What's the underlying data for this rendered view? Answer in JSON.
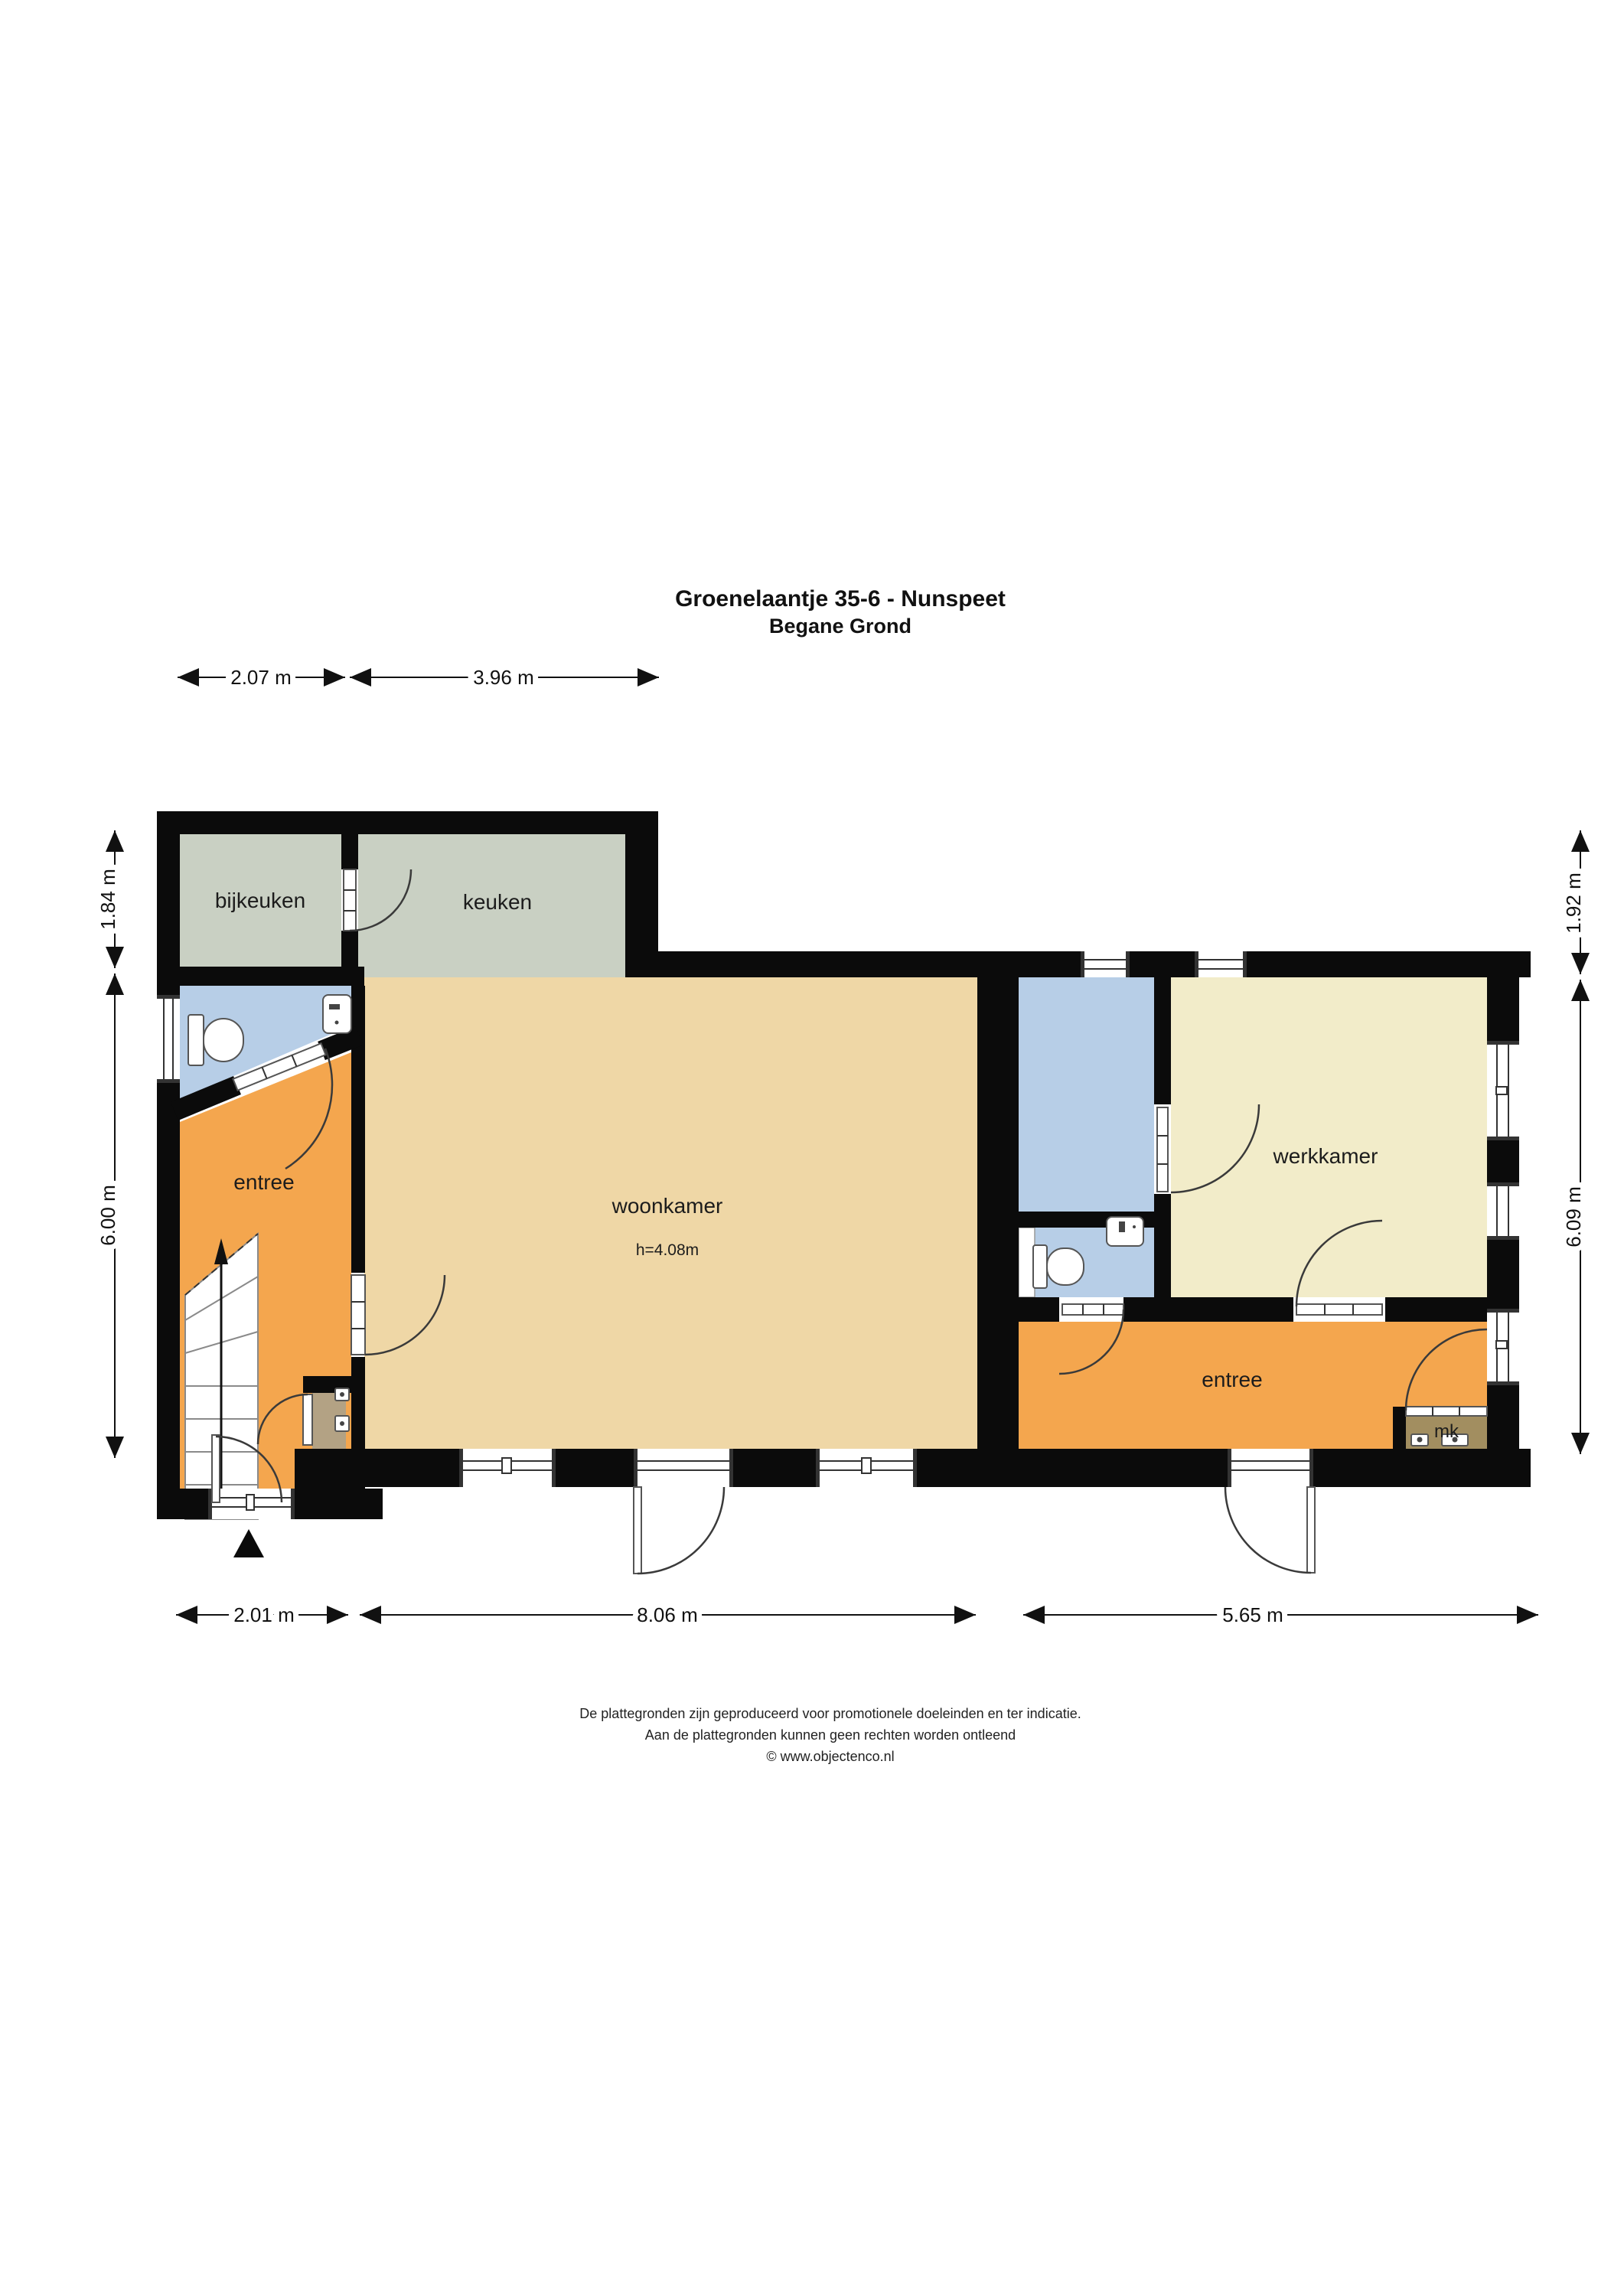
{
  "title": {
    "line1": "Groenelaantje 35-6 - Nunspeet",
    "line2": "Begane Grond"
  },
  "rooms": {
    "bijkeuken": {
      "label": "bijkeuken"
    },
    "keuken": {
      "label": "keuken"
    },
    "entree_left": {
      "label": "entree"
    },
    "woonkamer": {
      "label": "woonkamer",
      "height_note": "h=4.08m"
    },
    "werkkamer": {
      "label": "werkkamer"
    },
    "entree_right": {
      "label": "entree"
    },
    "meterkast": {
      "label": "mk"
    }
  },
  "dimensions": {
    "top": [
      {
        "label": "2.07 m"
      },
      {
        "label": "3.96 m"
      }
    ],
    "bottom": [
      {
        "label": "2.01 m"
      },
      {
        "label": "8.06 m"
      },
      {
        "label": "5.65 m"
      }
    ],
    "left": [
      {
        "label": "1.84 m"
      },
      {
        "label": "6.00 m"
      }
    ],
    "right": [
      {
        "label": "1.92 m"
      },
      {
        "label": "6.09 m"
      }
    ]
  },
  "footer": {
    "line1": "De plattegronden zijn geproduceerd voor promotionele doeleinden en ter indicatie.",
    "line2": "Aan de plattegronden kunnen geen rechten worden ontleend",
    "line3": "© www.objectenco.nl"
  },
  "colors": {
    "wall": "#0b0b0b",
    "kitchen": "#c9d0c3",
    "living": "#efd7a6",
    "hall": "#f4a64e",
    "work": "#f2ecc9",
    "wet": "#b7cee7",
    "closet": "#b3a284",
    "meter": "#a28e60",
    "paper": "#ffffff"
  }
}
